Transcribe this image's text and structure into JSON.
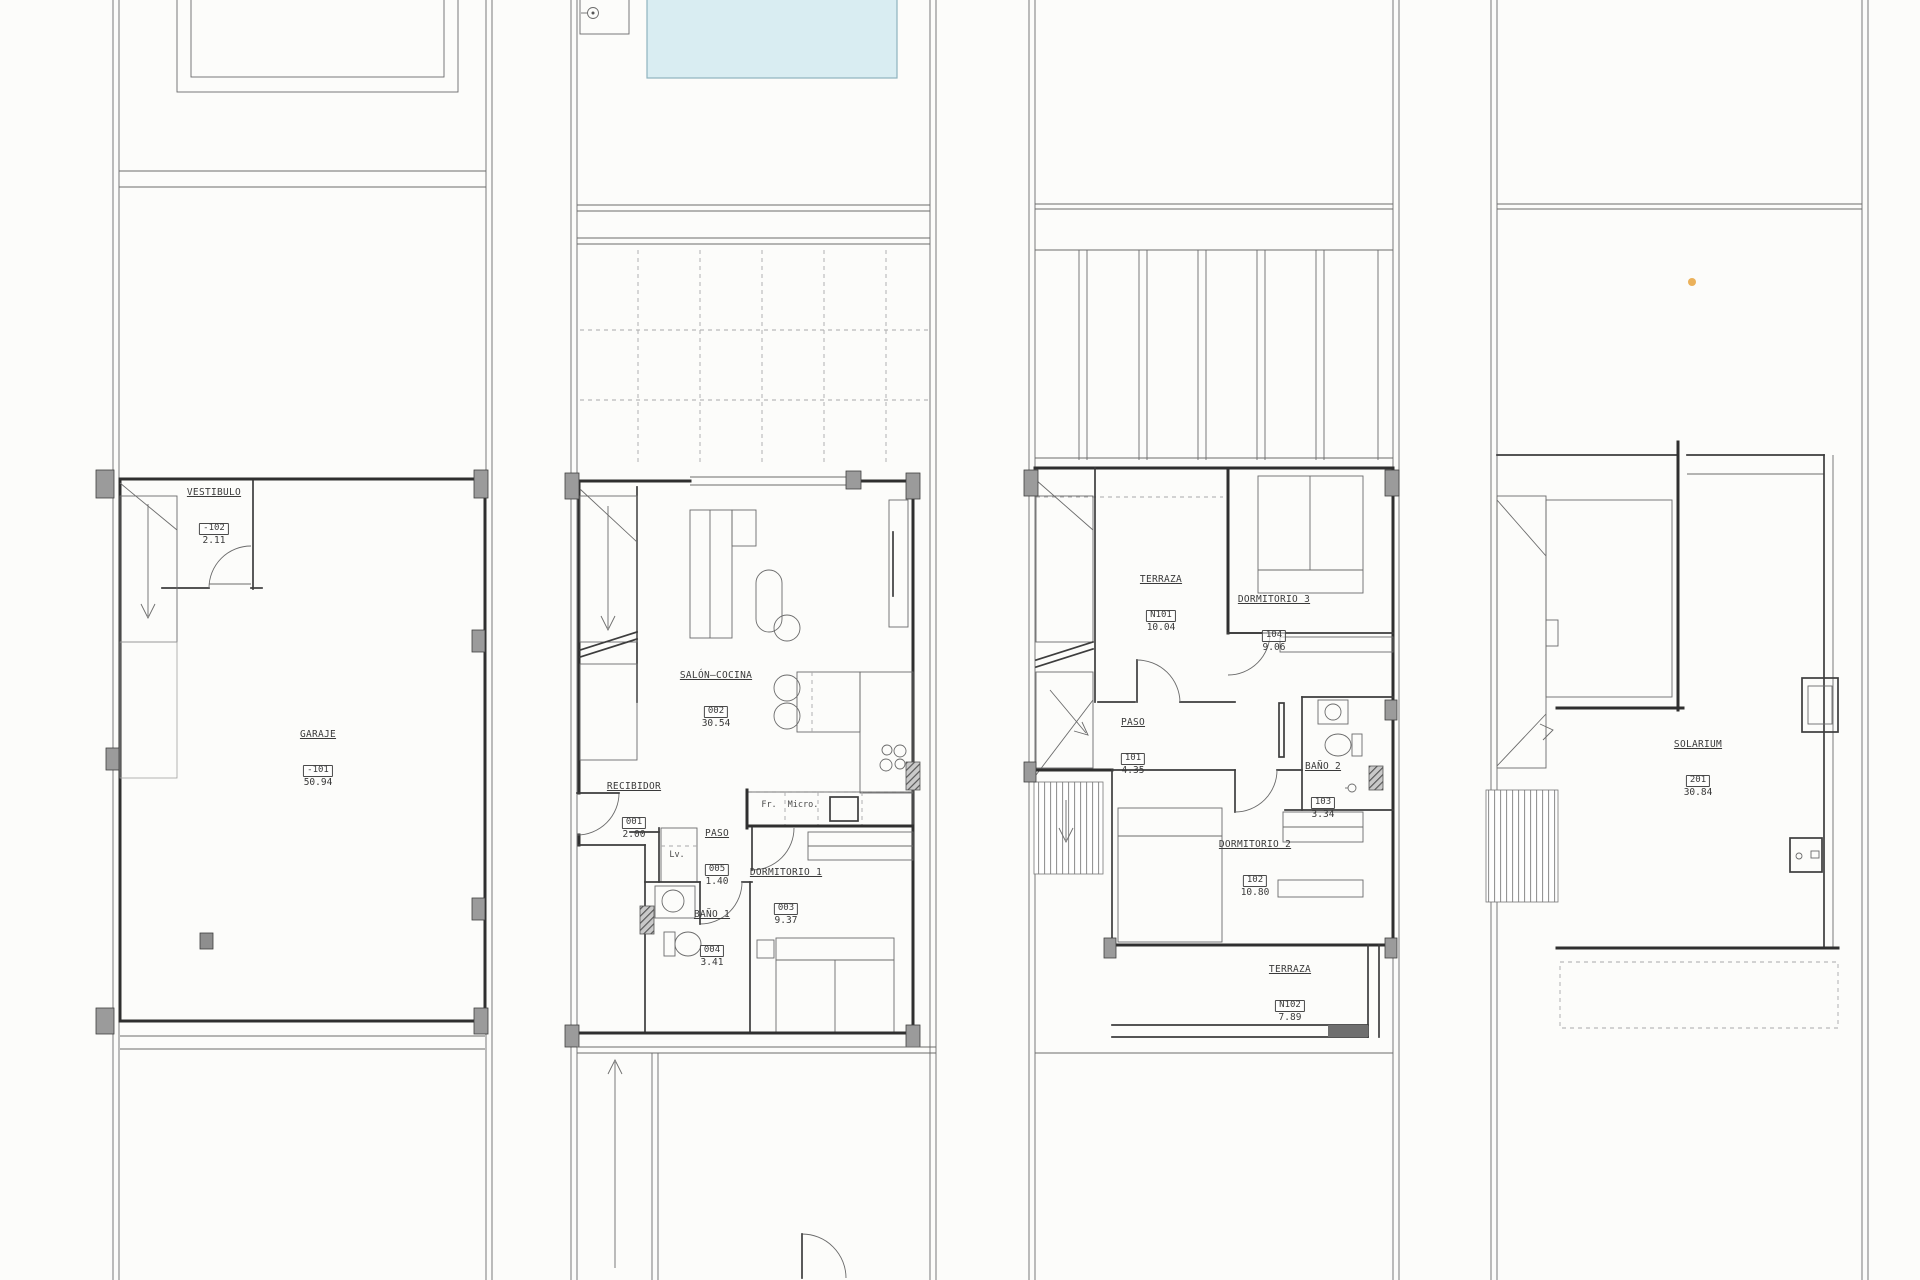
{
  "document": {
    "kind": "architectural floor plan sheet",
    "plan_count": 4
  },
  "colors": {
    "wall_line": "#2f2f2f",
    "thin_line": "#6b6b6b",
    "light_line": "#a0a0a0",
    "pool_fill": "#d9edf2",
    "pool_edge": "#8fb3bf",
    "pilaster_fill": "#9b9b9b",
    "hatch_fill": "#c9c9c9",
    "highlight_dot": "#e8a33d",
    "label_text": "#3a3a3a",
    "sheet_background": "#fcfcfa"
  },
  "rooms": {
    "vestibulo": {
      "name": "VESTIBULO",
      "code": "-102",
      "area": "2.11"
    },
    "garaje": {
      "name": "GARAJE",
      "code": "-101",
      "area": "50.94"
    },
    "salon_cocina": {
      "name": "SALÓN—COCINA",
      "code": "002",
      "area": "30.54"
    },
    "recibidor": {
      "name": "RECIBIDOR",
      "code": "001",
      "area": "2.00"
    },
    "paso_005": {
      "name": "PASO",
      "code": "005",
      "area": "1.40"
    },
    "bano_1": {
      "name": "BAÑO 1",
      "code": "004",
      "area": "3.41"
    },
    "dormitorio_1": {
      "name": "DORMITORIO 1",
      "code": "003",
      "area": "9.37"
    },
    "terraza_n101": {
      "name": "TERRAZA",
      "code": "N101",
      "area": "10.04"
    },
    "dormitorio_3": {
      "name": "DORMITORIO 3",
      "code": "104",
      "area": "9.06"
    },
    "paso_101": {
      "name": "PASO",
      "code": "101",
      "area": "4.35"
    },
    "bano_2": {
      "name": "BAÑO 2",
      "code": "103",
      "area": "3.34"
    },
    "dormitorio_2": {
      "name": "DORMITORIO 2",
      "code": "102",
      "area": "10.80"
    },
    "terraza_n102": {
      "name": "TERRAZA",
      "code": "N102",
      "area": "7.89"
    },
    "solarium": {
      "name": "SOLARIUM",
      "code": "201",
      "area": "30.84"
    }
  },
  "appliances": {
    "fridge": "Fr.",
    "microwave": "Micro.",
    "washer": "Lv."
  }
}
